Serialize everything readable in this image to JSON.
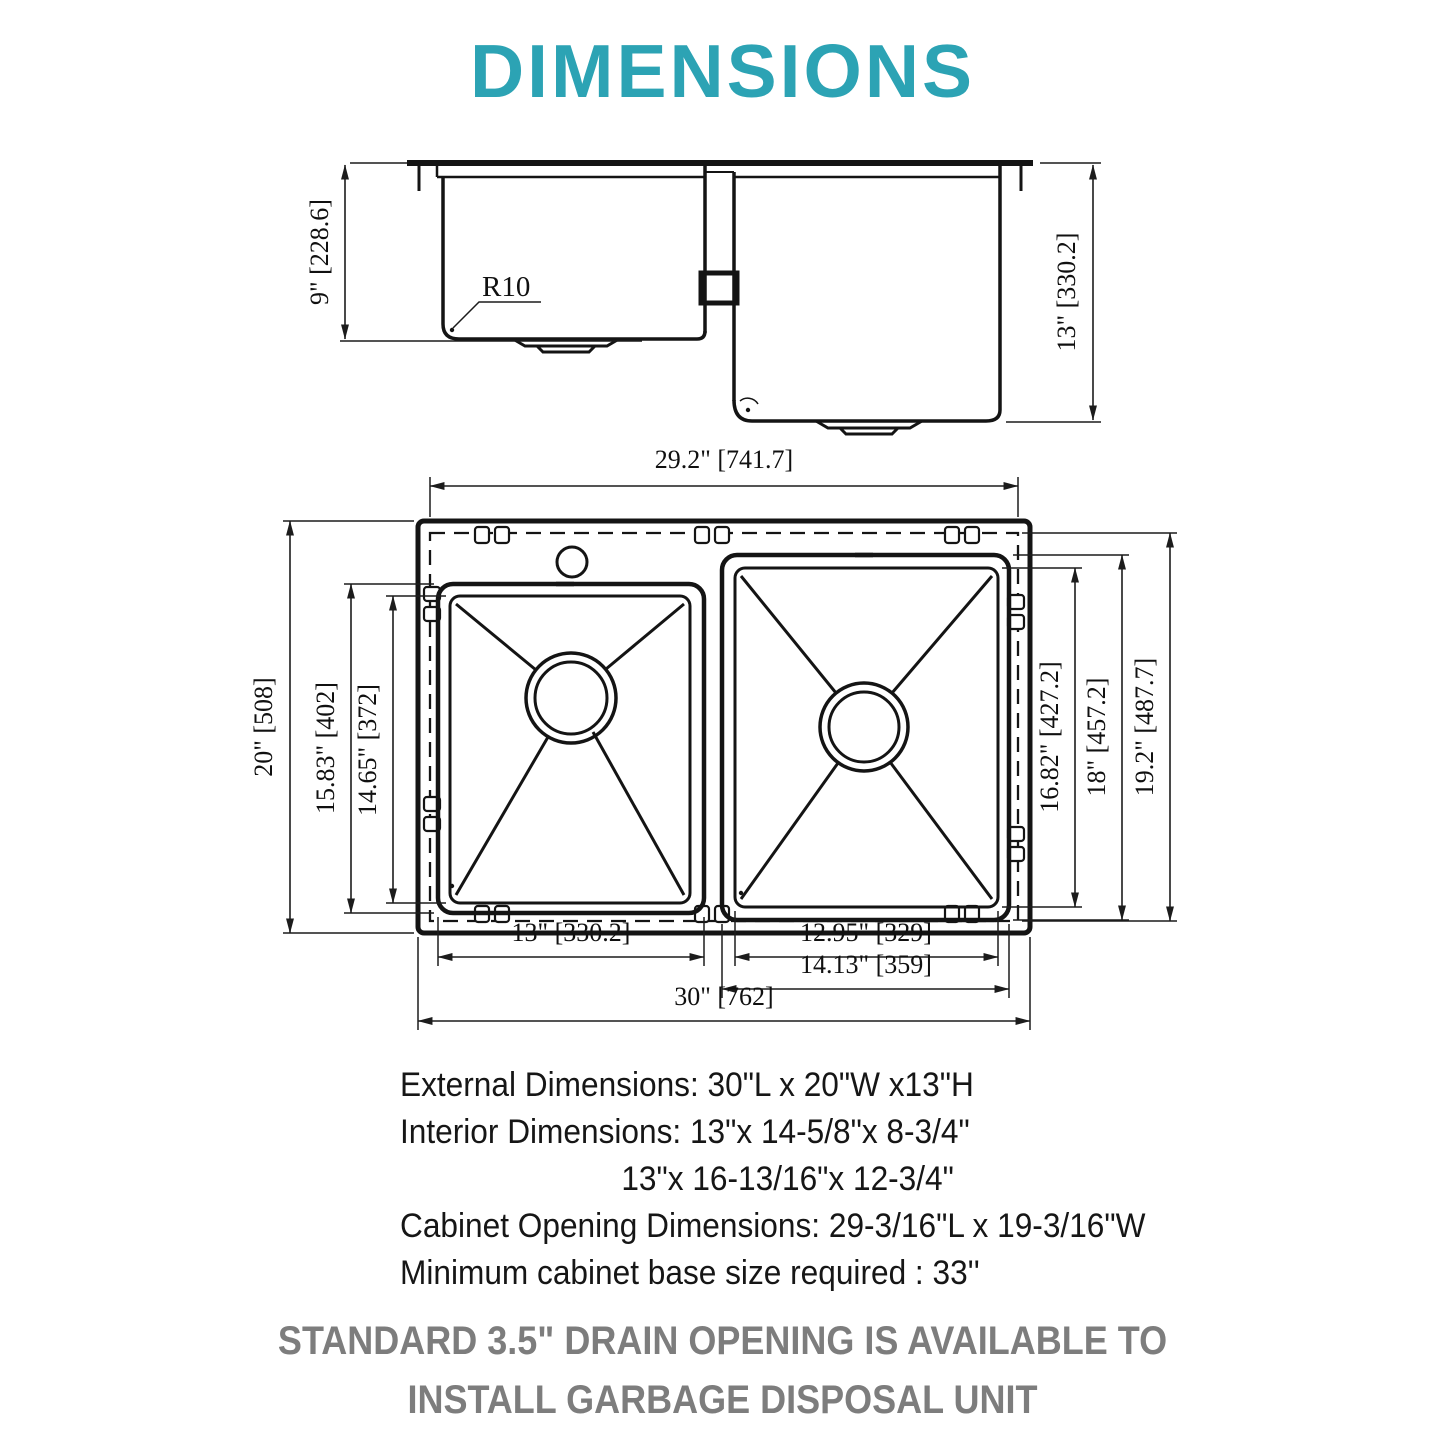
{
  "title": "DIMENSIONS",
  "colors": {
    "accent": "#2CA3B4",
    "line": "#141414",
    "note_gray": "#7d7d7d"
  },
  "side_view": {
    "left_bowl_depth": "9\" [228.6]",
    "right_bowl_depth": "13\" [330.2]",
    "corner_radius": "R10"
  },
  "top_view": {
    "cutout_length": "29.2\" [741.7]",
    "overall_width": "20\" [508]",
    "left_bowl_outer_length": "15.83\" [402]",
    "left_bowl_inner_length": "14.65\" [372]",
    "right_bowl_inner_length": "16.82\" [427.2]",
    "right_bowl_outer_length": "18\" [457.2]",
    "cutout_width": "19.2\" [487.7]",
    "left_bowl_width": "13\" [330.2]",
    "right_bowl_inner_width": "12.95\" [329]",
    "right_bowl_outer_width": "14.13\" [359]",
    "overall_length": "30\" [762]"
  },
  "specs": {
    "line1": "External Dimensions: 30\"L x 20\"W x13\"H",
    "line2": "Interior Dimensions: 13\"x 14-5/8\"x 8-3/4\"",
    "line3": "13\"x 16-13/16\"x 12-3/4\"",
    "line4": "Cabinet Opening Dimensions: 29-3/16\"L x 19-3/16\"W",
    "line5": "Minimum cabinet base size required : 33''"
  },
  "note": {
    "line1": "STANDARD 3.5\" DRAIN OPENING IS AVAILABLE TO",
    "line2": "INSTALL GARBAGE DISPOSAL UNIT"
  }
}
